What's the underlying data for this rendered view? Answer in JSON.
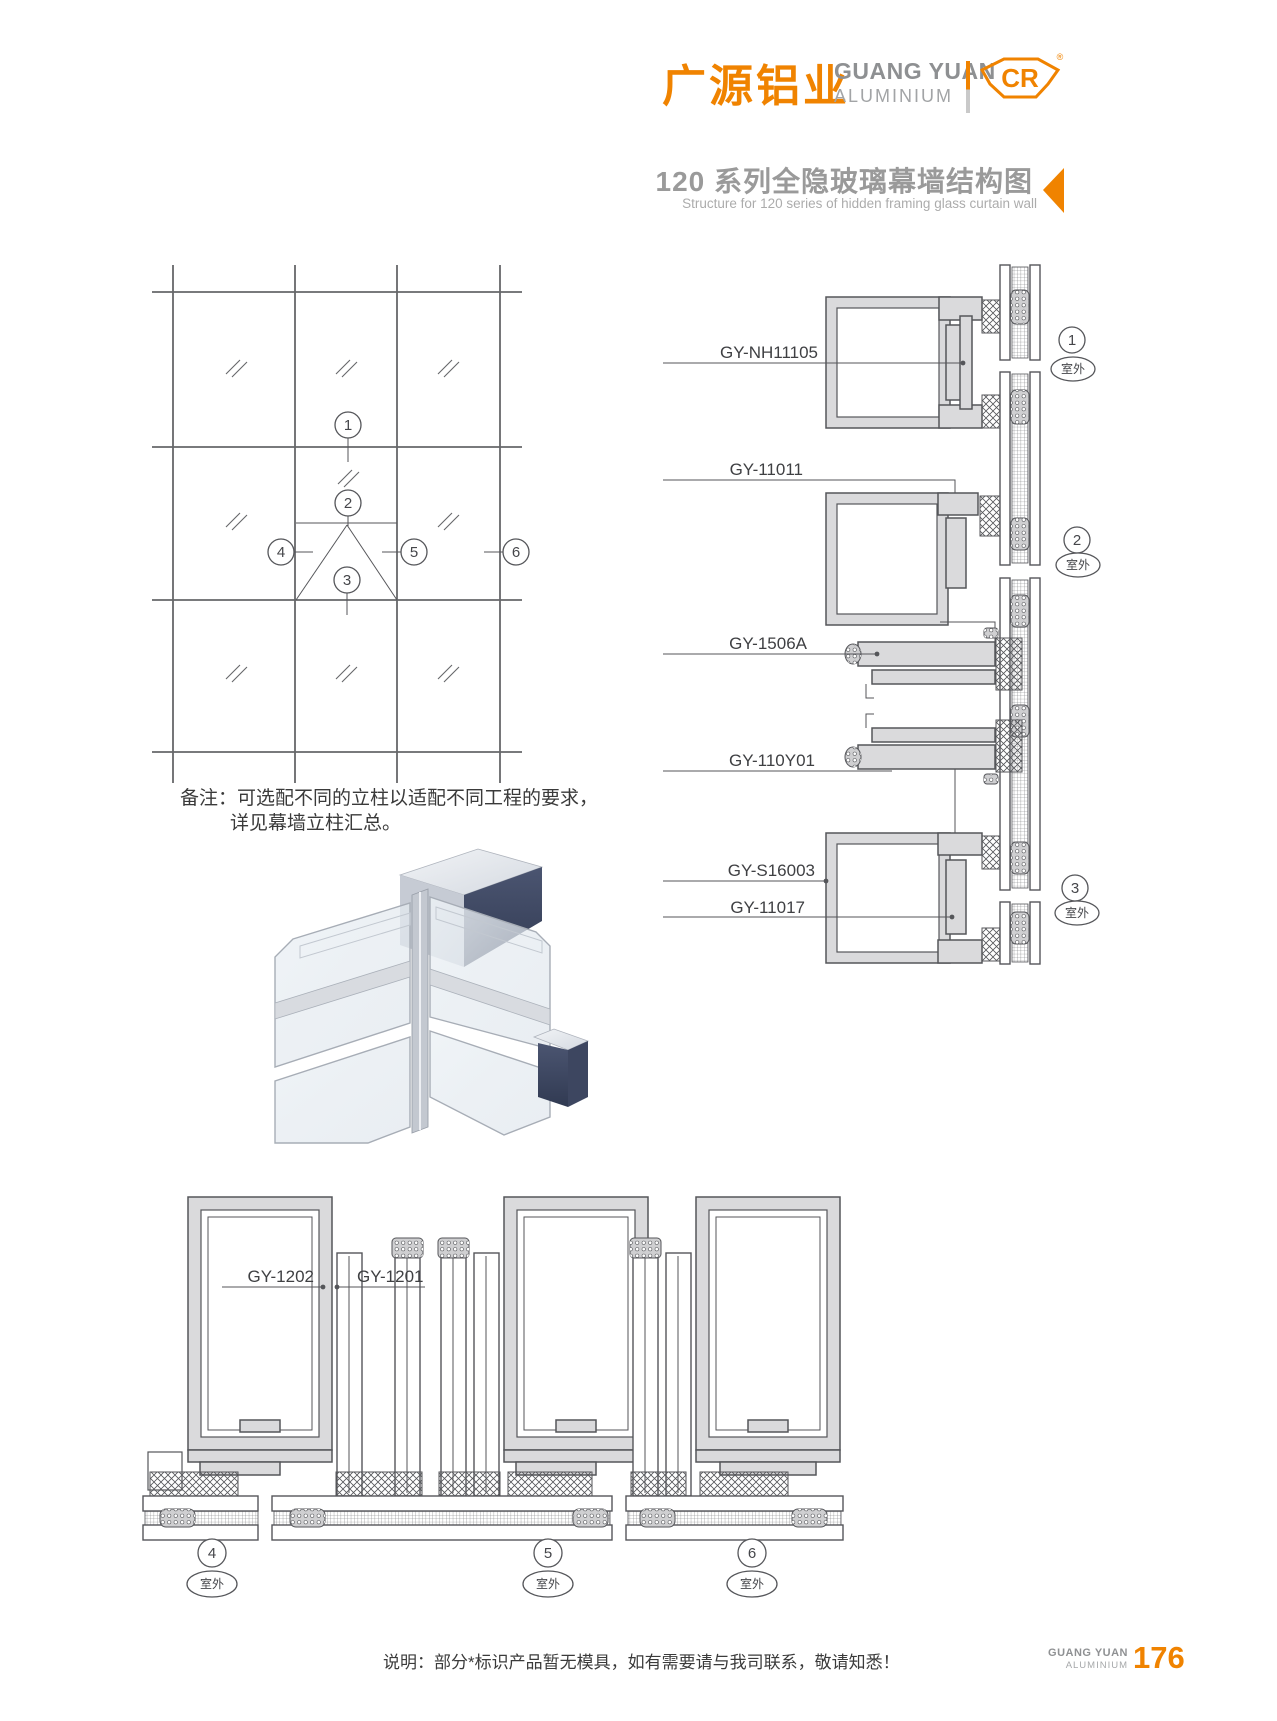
{
  "header": {
    "logo_cn": "广源铝业",
    "logo_en_line1": "GUANG YUAN",
    "logo_en_line2": "ALUMINIUM",
    "logo_mark_text": "CR",
    "registered_mark": "®",
    "title_cn": "120 系列全隐玻璃幕墙结构图",
    "title_en": "Structure for 120 series of hidden framing glass curtain wall"
  },
  "colors": {
    "brand_orange": "#F08300",
    "title_gray": "#9A9A9A",
    "drawing_line": "#55565A",
    "aluminium_fill": "#DADADC"
  },
  "elevation": {
    "callouts": [
      "1",
      "2",
      "3",
      "4",
      "5",
      "6"
    ]
  },
  "note": {
    "label": "备注：",
    "line1": "可选配不同的立柱以适配不同工程的要求，",
    "line2": "详见幕墙立柱汇总。"
  },
  "right_details": {
    "profile_labels": {
      "l1": "GY-NH11105",
      "l2": "GY-11011",
      "l3": "GY-1506A",
      "l4": "GY-110Y01",
      "l5": "GY-S16003",
      "l6": "GY-11017"
    },
    "callouts": [
      {
        "num": "1",
        "outdoor": "室外"
      },
      {
        "num": "2",
        "outdoor": "室外"
      },
      {
        "num": "3",
        "outdoor": "室外"
      }
    ]
  },
  "bottom_details": {
    "profile_labels": {
      "l1": "GY-1202",
      "l2": "GY-1201"
    },
    "callouts": [
      {
        "num": "4",
        "outdoor": "室外"
      },
      {
        "num": "5",
        "outdoor": "室外"
      },
      {
        "num": "6",
        "outdoor": "室外"
      }
    ]
  },
  "footer": {
    "note": "说明：部分*标识产品暂无模具，如有需要请与我司联系，敬请知悉！",
    "brand_line1": "GUANG YUAN",
    "brand_line2": "ALUMINIUM",
    "page_number": "176"
  }
}
